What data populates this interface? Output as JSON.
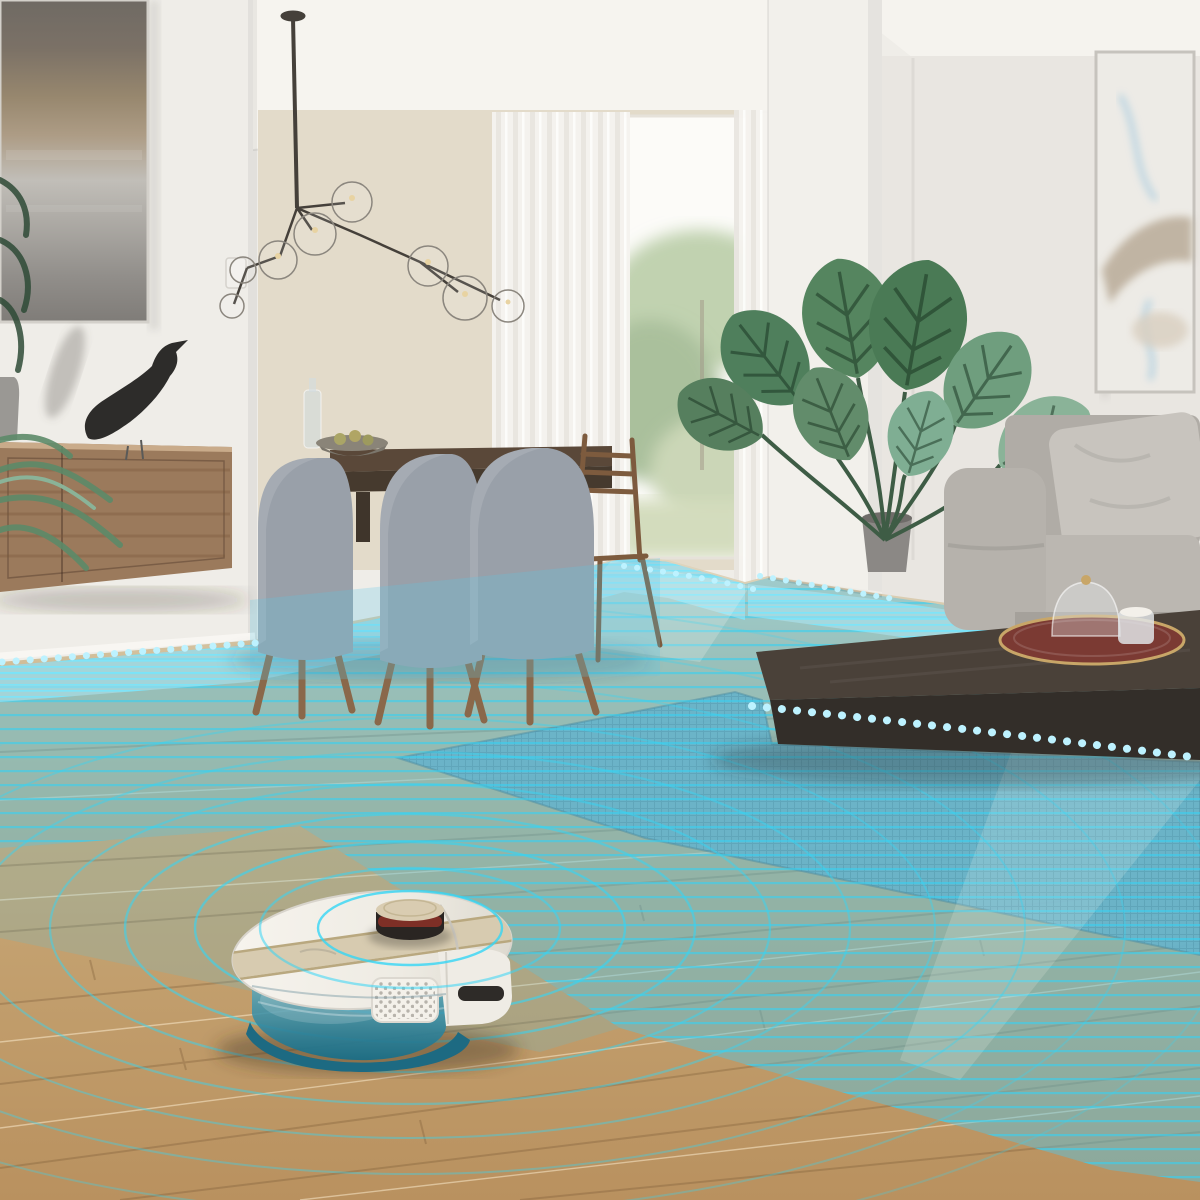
{
  "palette": {
    "ceiling": "#f6f4ef",
    "wall_white": "#efede8",
    "wall_warm": "#e3dbca",
    "partition": "#f2f0eb",
    "wall_right": "#e9e6e1",
    "floor_far": "#d7cbae",
    "floor_near": "#c09c6d",
    "plank_seam": "#7a5a36",
    "overlay_fill": "rgba(88,196,227,0.46)",
    "overlay_far_band": "rgba(173,233,249,0.5)",
    "scan_line": "rgba(56,208,240,0.6)",
    "ring": "#35d6f5",
    "dots": "#bdf2ff",
    "rug": "#76a5b5",
    "credenza_wood": "#9b7a5c",
    "painting_frame": "#d3d0ca",
    "bird_black": "#2d2c2a",
    "chair_fabric": "#99a0a9",
    "chair_leg": "#8a684a",
    "dining_table": "#5a4839",
    "curtain": "#f6f4f0",
    "window_green": "#8fae7c",
    "sofa": "#b6b2ac",
    "sofa_pillow": "#c8c4be",
    "coffee_table_top": "#4a4139",
    "coffee_table_front": "#332e29",
    "tray_red": "#7b3a33",
    "tray_gold": "#c8a668",
    "plant_dark": "#3f6a4c",
    "plant_mid": "#5c8a68",
    "plant_pale": "#8ab398",
    "robot_white": "#f2efe8",
    "robot_stripe": "#d7cbb0",
    "turret_top": "#d9ccb1",
    "turret_band": "#7e2f26",
    "tank_teal": "#2e8aa4",
    "tank_deep": "#1d6a82",
    "grille_dot": "#b7b3ab"
  },
  "overlay": {
    "type": "lidar-scan-visualization",
    "ring_count": 10,
    "ring_radii": [
      92,
      150,
      215,
      285,
      360,
      440,
      525,
      615,
      715,
      815
    ],
    "dot_rows": 4,
    "scanline_spacing_px": 14,
    "dense_band_spacing_px": 6,
    "cleaned_area": "mid-floor swath tinted cyan",
    "uncleaned_area": "foreground oak planks"
  },
  "room": {
    "objects": [
      "abstract-painting",
      "floating-credenza",
      "eames-house-bird",
      "ceramic-vase",
      "grass-plant",
      "light-switch",
      "branching-bubble-chandelier",
      "dining-table",
      "upholstered-chairs",
      "wooden-chair",
      "fruit-bowl",
      "glass-bottle",
      "sheer-curtains",
      "garden-window",
      "partition-wall",
      "monstera-plant",
      "wall-art",
      "fabric-sofa",
      "throw-pillow",
      "coffee-table",
      "decor-tray",
      "glass-cloche",
      "candle",
      "woven-rug",
      "oak-floor"
    ]
  },
  "robot": {
    "type": "robot-vacuum",
    "state": "mapping-floor-with-lidar",
    "features": [
      "lidar-turret",
      "turret-sensor-band",
      "top-deck-stripe",
      "water-tank",
      "mop-plate",
      "dustbin-grille",
      "bumper-sensor"
    ]
  },
  "counts": {
    "dining_chairs": 3,
    "chandelier_globes": 8,
    "monstera_leaves": 8
  }
}
